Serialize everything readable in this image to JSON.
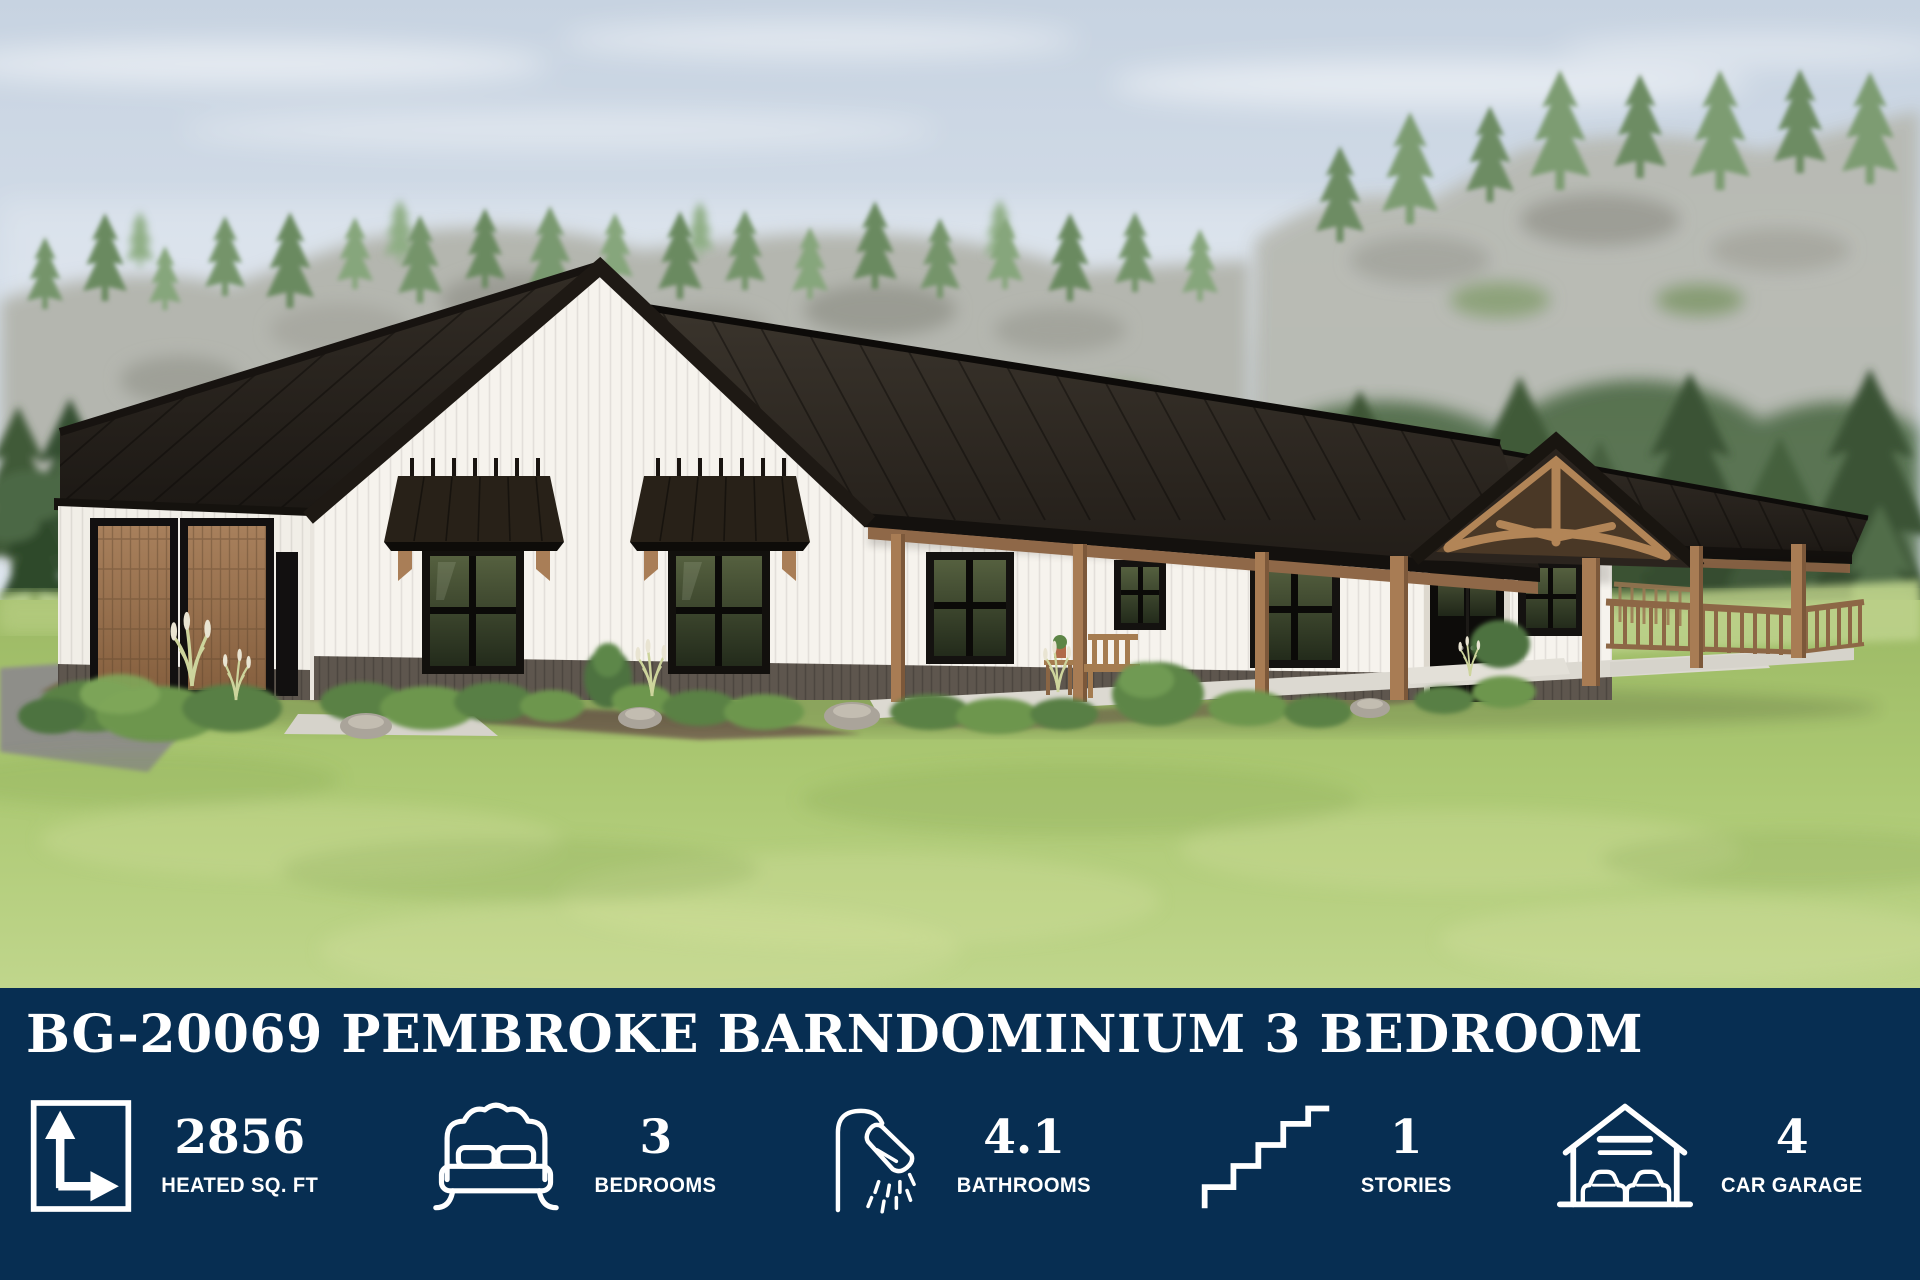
{
  "banner": {
    "title": "BG-20069 PEMBROKE BARNDOMINIUM 3 BEDROOM",
    "colors": {
      "background": "#072e52",
      "text": "#ffffff"
    },
    "stats": [
      {
        "icon": "square-footage-icon",
        "value": "2856",
        "label": "HEATED SQ. FT"
      },
      {
        "icon": "bed-icon",
        "value": "3",
        "label": "BEDROOMS"
      },
      {
        "icon": "shower-icon",
        "value": "4.1",
        "label": "BATHROOMS"
      },
      {
        "icon": "stairs-icon",
        "value": "1",
        "label": "STORIES"
      },
      {
        "icon": "garage-icon",
        "value": "4",
        "label": "CAR GARAGE"
      }
    ]
  },
  "scene": {
    "subject": "3D exterior rendering: single-story white board-and-batten barndominium, black standing-seam metal roof, two brown wood garage doors, black-frame windows with metal awnings, timber-post wrap-around porch with entry gable truss, green lawn, shrubs, rocky tree-covered bluff and pine forest background",
    "colors": {
      "roof": "#2a2520",
      "siding": "#f6f3ed",
      "wainscot": "#5e564e",
      "garage_door": "#9c7250",
      "timber": "#a87c54",
      "lawn": "#abc872",
      "sky": "#cdd9e6"
    }
  }
}
